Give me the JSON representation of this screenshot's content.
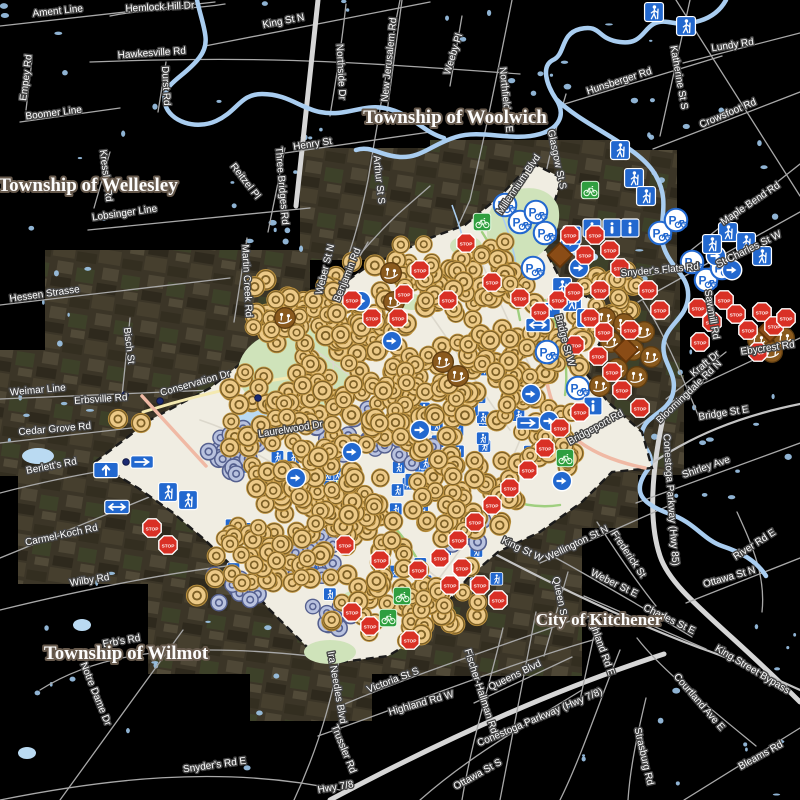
{
  "map": {
    "background": "#000000",
    "boundary_labels": [
      {
        "text": "Township of Wellesley",
        "x": 88,
        "y": 191,
        "size": 19
      },
      {
        "text": "Township of Woolwich",
        "x": 455,
        "y": 123,
        "size": 19
      },
      {
        "text": "Township of Wilmot",
        "x": 126,
        "y": 659,
        "size": 19
      },
      {
        "text": "City of Kitchener",
        "x": 599,
        "y": 625,
        "size": 17
      }
    ],
    "road_labels": [
      [
        "Ament Line",
        58,
        14,
        -6
      ],
      [
        "Hemlock Hill Dr",
        160,
        10,
        -3
      ],
      [
        "King St N",
        284,
        24,
        -11
      ],
      [
        "Hawkesville Rd",
        152,
        56,
        -4
      ],
      [
        "Empey Rd",
        29,
        78,
        -83
      ],
      [
        "Durst Rd",
        163,
        86,
        87
      ],
      [
        "Boomer Line",
        54,
        116,
        -7
      ],
      [
        "Northside Dr",
        338,
        72,
        87
      ],
      [
        "Henry St",
        313,
        147,
        -9
      ],
      [
        "Kressler Rd",
        103,
        176,
        83
      ],
      [
        "Lobsinger Line",
        125,
        216,
        -8
      ],
      [
        "Reitzel Pl",
        243,
        183,
        52
      ],
      [
        "Three Bridges Rd",
        279,
        186,
        85
      ],
      [
        "Martin Creek Rd",
        244,
        281,
        87
      ],
      [
        "Hessen Strasse",
        45,
        297,
        -8
      ],
      [
        "Bisch St",
        126,
        346,
        83
      ],
      [
        "Weimar Line",
        38,
        393,
        -5
      ],
      [
        "Erbsville Rd",
        101,
        402,
        -4
      ],
      [
        "Cedar Grove Rd",
        55,
        432,
        -5
      ],
      [
        "Berlett's Rd",
        52,
        469,
        -11
      ],
      [
        "Carmel-Koch Rd",
        62,
        538,
        -12
      ],
      [
        "Wilby Rd",
        90,
        583,
        -9
      ],
      [
        "New Jerusalem Rd",
        392,
        60,
        -84
      ],
      [
        "Arthur St S",
        376,
        180,
        84
      ],
      [
        "Weber St N",
        328,
        270,
        -76
      ],
      [
        "Benjamin Rd",
        350,
        276,
        -68
      ],
      [
        "Weeby Pl",
        456,
        55,
        -73
      ],
      [
        "Northfield Dr E",
        503,
        100,
        84
      ],
      [
        "Hunsberger Rd",
        620,
        84,
        -18
      ],
      [
        "Katherine St S",
        676,
        78,
        80
      ],
      [
        "Lundy Rd",
        733,
        48,
        -9
      ],
      [
        "Crowsfoot Rd",
        729,
        116,
        -23
      ],
      [
        "Glasgow St S",
        554,
        160,
        78
      ],
      [
        "Millennium Blvd",
        521,
        186,
        -56
      ],
      [
        "Maple Bend Rd",
        752,
        206,
        -34
      ],
      [
        "St Charles St W",
        750,
        252,
        -26
      ],
      [
        "Snyder's Flats Rd",
        660,
        273,
        -5
      ],
      [
        "Sawmill Rd",
        709,
        315,
        80
      ],
      [
        "Ebycrest Rd",
        768,
        351,
        -8
      ],
      [
        "Kraft Dr",
        707,
        366,
        -40
      ],
      [
        "Bloomingdale Rd N",
        691,
        394,
        -44
      ],
      [
        "Bridge St E",
        724,
        416,
        -9
      ],
      [
        "Bridge St W",
        562,
        341,
        75
      ],
      [
        "Bridgeport Rd",
        597,
        430,
        -29
      ],
      [
        "Shirley Ave",
        707,
        470,
        -19
      ],
      [
        "Conestoga Parkway (Hwy 85)",
        668,
        500,
        86
      ],
      [
        "Wellington St N",
        578,
        546,
        -26
      ],
      [
        "Frederick St",
        626,
        556,
        56
      ],
      [
        "Weber St E",
        613,
        586,
        26
      ],
      [
        "King St W",
        521,
        552,
        26
      ],
      [
        "Queen St",
        557,
        598,
        78
      ],
      [
        "Charles St E",
        668,
        622,
        26
      ],
      [
        "Highland Rd E",
        598,
        646,
        70
      ],
      [
        "King Street Bypass",
        751,
        672,
        31
      ],
      [
        "Courtland Ave E",
        697,
        704,
        49
      ],
      [
        "Ottawa St N",
        730,
        580,
        -16
      ],
      [
        "River Rd E",
        756,
        547,
        -33
      ],
      [
        "Ottawa St S",
        479,
        777,
        -29
      ],
      [
        "Strasburg Rd",
        641,
        757,
        77
      ],
      [
        "Bleams Rd",
        762,
        758,
        -29
      ],
      [
        "Conestoga Parkway (Hwy 7/8)",
        541,
        720,
        -23
      ],
      [
        "Highland Rd W",
        422,
        706,
        -16
      ],
      [
        "Victoria St S",
        394,
        683,
        -21
      ],
      [
        "Fischer-Hallman Rd",
        478,
        692,
        72
      ],
      [
        "Queens Blvd",
        516,
        678,
        -26
      ],
      [
        "Ira Needles Blvd",
        334,
        688,
        80
      ],
      [
        "Trussler Rd",
        341,
        750,
        68
      ],
      [
        "Hwy 7/8",
        336,
        790,
        -9
      ],
      [
        "Snyder's Rd E",
        215,
        768,
        -8
      ],
      [
        "Notre Dame Dr",
        93,
        695,
        68
      ],
      [
        "Erb's Rd",
        122,
        644,
        -10
      ],
      [
        "Laurelwood Dr",
        291,
        432,
        -9
      ],
      [
        "Conservation Dr",
        196,
        386,
        -16
      ]
    ]
  },
  "markers": {
    "palette": {
      "tan_fill": "#ecc987",
      "tan_ring": "#7d6026",
      "tan_edge": "#c19540",
      "lavender_fill": "#b9c2de",
      "lavender_ring": "#55608f",
      "sign_blue": "#2268cf",
      "stop_red": "#d93025",
      "route_green": "#2f9e3f",
      "playground_brown": "#8a5a1e",
      "diamond_brown": "#8a4c16",
      "dot_navy": "#1b2a70"
    },
    "tan_clusters": [
      [
        330,
        325,
        95,
        55,
        80
      ],
      [
        455,
        282,
        95,
        50,
        75
      ],
      [
        285,
        415,
        80,
        55,
        60
      ],
      [
        405,
        395,
        85,
        65,
        70
      ],
      [
        505,
        375,
        65,
        55,
        50
      ],
      [
        350,
        515,
        95,
        65,
        70
      ],
      [
        465,
        495,
        75,
        55,
        50
      ],
      [
        255,
        555,
        65,
        45,
        40
      ],
      [
        405,
        598,
        85,
        45,
        55
      ],
      [
        612,
        300,
        45,
        40,
        25
      ],
      [
        545,
        440,
        45,
        40,
        25
      ],
      [
        300,
        470,
        60,
        40,
        30
      ],
      [
        555,
        345,
        40,
        35,
        20
      ]
    ],
    "tan_singles": [
      [
        118,
        419
      ],
      [
        141,
        423
      ],
      [
        413,
        510
      ],
      [
        352,
        262
      ]
    ],
    "lavender_clusters": [
      [
        235,
        455,
        35,
        30,
        16
      ],
      [
        350,
        430,
        45,
        30,
        14
      ],
      [
        310,
        560,
        40,
        35,
        16
      ],
      [
        240,
        590,
        35,
        25,
        12
      ],
      [
        470,
        540,
        30,
        25,
        10
      ],
      [
        410,
        455,
        35,
        30,
        10
      ],
      [
        330,
        620,
        30,
        20,
        8
      ]
    ],
    "under_sign_clusters": [
      [
        350,
        470,
        120,
        90,
        25
      ],
      [
        470,
        420,
        100,
        80,
        20
      ],
      [
        280,
        560,
        80,
        60,
        12
      ],
      [
        420,
        580,
        80,
        50,
        12
      ]
    ],
    "stop_signs": [
      [
        404,
        294
      ],
      [
        420,
        270
      ],
      [
        466,
        243
      ],
      [
        372,
        318
      ],
      [
        352,
        300
      ],
      [
        398,
        318
      ],
      [
        448,
        300
      ],
      [
        492,
        282
      ],
      [
        520,
        298
      ],
      [
        540,
        312
      ],
      [
        558,
        300
      ],
      [
        574,
        292
      ],
      [
        590,
        318
      ],
      [
        604,
        332
      ],
      [
        575,
        345
      ],
      [
        598,
        356
      ],
      [
        612,
        372
      ],
      [
        622,
        390
      ],
      [
        640,
        408
      ],
      [
        580,
        412
      ],
      [
        560,
        428
      ],
      [
        545,
        448
      ],
      [
        528,
        470
      ],
      [
        510,
        488
      ],
      [
        492,
        505
      ],
      [
        475,
        522
      ],
      [
        458,
        540
      ],
      [
        440,
        558
      ],
      [
        462,
        568
      ],
      [
        480,
        585
      ],
      [
        498,
        600
      ],
      [
        450,
        585
      ],
      [
        418,
        570
      ],
      [
        380,
        560
      ],
      [
        345,
        545
      ],
      [
        610,
        250
      ],
      [
        595,
        235
      ],
      [
        620,
        268
      ],
      [
        648,
        290
      ],
      [
        660,
        310
      ],
      [
        600,
        290
      ],
      [
        630,
        330
      ],
      [
        585,
        255
      ],
      [
        570,
        235
      ],
      [
        152,
        528
      ],
      [
        168,
        545
      ],
      [
        698,
        308
      ],
      [
        712,
        322
      ],
      [
        724,
        300
      ],
      [
        736,
        314
      ],
      [
        748,
        330
      ],
      [
        762,
        312
      ],
      [
        700,
        342
      ],
      [
        774,
        326
      ],
      [
        758,
        352
      ],
      [
        786,
        318
      ],
      [
        352,
        612
      ],
      [
        370,
        626
      ],
      [
        410,
        640
      ]
    ],
    "arrow_circles": [
      [
        570,
        243
      ],
      [
        579,
        268
      ],
      [
        531,
        394
      ],
      [
        549,
        421
      ],
      [
        296,
        478
      ],
      [
        352,
        452
      ],
      [
        420,
        430
      ],
      [
        392,
        341
      ],
      [
        361,
        301
      ],
      [
        562,
        481
      ],
      [
        732,
        270
      ],
      [
        716,
        256
      ]
    ],
    "bike_parking": [
      [
        520,
        222
      ],
      [
        545,
        233
      ],
      [
        533,
        268
      ],
      [
        536,
        212
      ],
      [
        547,
        352
      ],
      [
        578,
        388
      ],
      [
        660,
        233
      ],
      [
        676,
        220
      ],
      [
        692,
        262
      ],
      [
        706,
        280
      ],
      [
        505,
        205
      ],
      [
        722,
        268
      ]
    ],
    "trail_signs": [
      [
        654,
        12
      ],
      [
        686,
        26
      ],
      [
        620,
        150
      ],
      [
        634,
        178
      ],
      [
        646,
        196
      ],
      [
        562,
        287
      ],
      [
        572,
        302
      ],
      [
        586,
        318
      ],
      [
        168,
        492
      ],
      [
        188,
        500
      ],
      [
        728,
        232
      ],
      [
        746,
        242
      ],
      [
        762,
        256
      ],
      [
        712,
        244
      ]
    ],
    "info_signs": [
      [
        572,
        235
      ],
      [
        592,
        228
      ],
      [
        612,
        228
      ],
      [
        630,
        228
      ],
      [
        593,
        406
      ]
    ],
    "up_arrow_signs": [
      [
        106,
        470
      ],
      [
        548,
        310
      ]
    ],
    "double_arrow_signs": [
      [
        538,
        325
      ],
      [
        117,
        507
      ]
    ],
    "right_arrow_signs": [
      [
        142,
        462
      ],
      [
        528,
        423
      ]
    ],
    "bike_route_signs": [
      [
        482,
        222
      ],
      [
        590,
        190
      ],
      [
        388,
        618
      ],
      [
        565,
        458
      ],
      [
        402,
        596
      ]
    ],
    "playground_markers": [
      [
        605,
        318
      ],
      [
        624,
        324
      ],
      [
        644,
        332
      ],
      [
        611,
        342
      ],
      [
        633,
        350
      ],
      [
        651,
        357
      ],
      [
        617,
        369
      ],
      [
        637,
        377
      ],
      [
        600,
        386
      ],
      [
        443,
        362
      ],
      [
        458,
        376
      ],
      [
        285,
        318
      ],
      [
        391,
        273
      ],
      [
        394,
        302
      ],
      [
        758,
        340
      ],
      [
        772,
        352
      ],
      [
        784,
        338
      ]
    ],
    "hazard_diamonds": [
      [
        560,
        255
      ],
      [
        626,
        350
      ],
      [
        770,
        330
      ]
    ],
    "survey_dots": [
      [
        125,
        395
      ],
      [
        160,
        401
      ],
      [
        126,
        462
      ],
      [
        137,
        462
      ],
      [
        258,
        398
      ]
    ]
  },
  "ponds": {
    "seed": 7,
    "regions": [
      [
        0,
        0,
        420,
        250,
        26
      ],
      [
        620,
        40,
        180,
        240,
        16
      ],
      [
        640,
        300,
        160,
        200,
        14
      ],
      [
        540,
        620,
        260,
        180,
        14
      ],
      [
        0,
        560,
        300,
        240,
        18
      ],
      [
        0,
        250,
        90,
        300,
        10
      ],
      [
        430,
        0,
        180,
        120,
        10
      ]
    ]
  }
}
